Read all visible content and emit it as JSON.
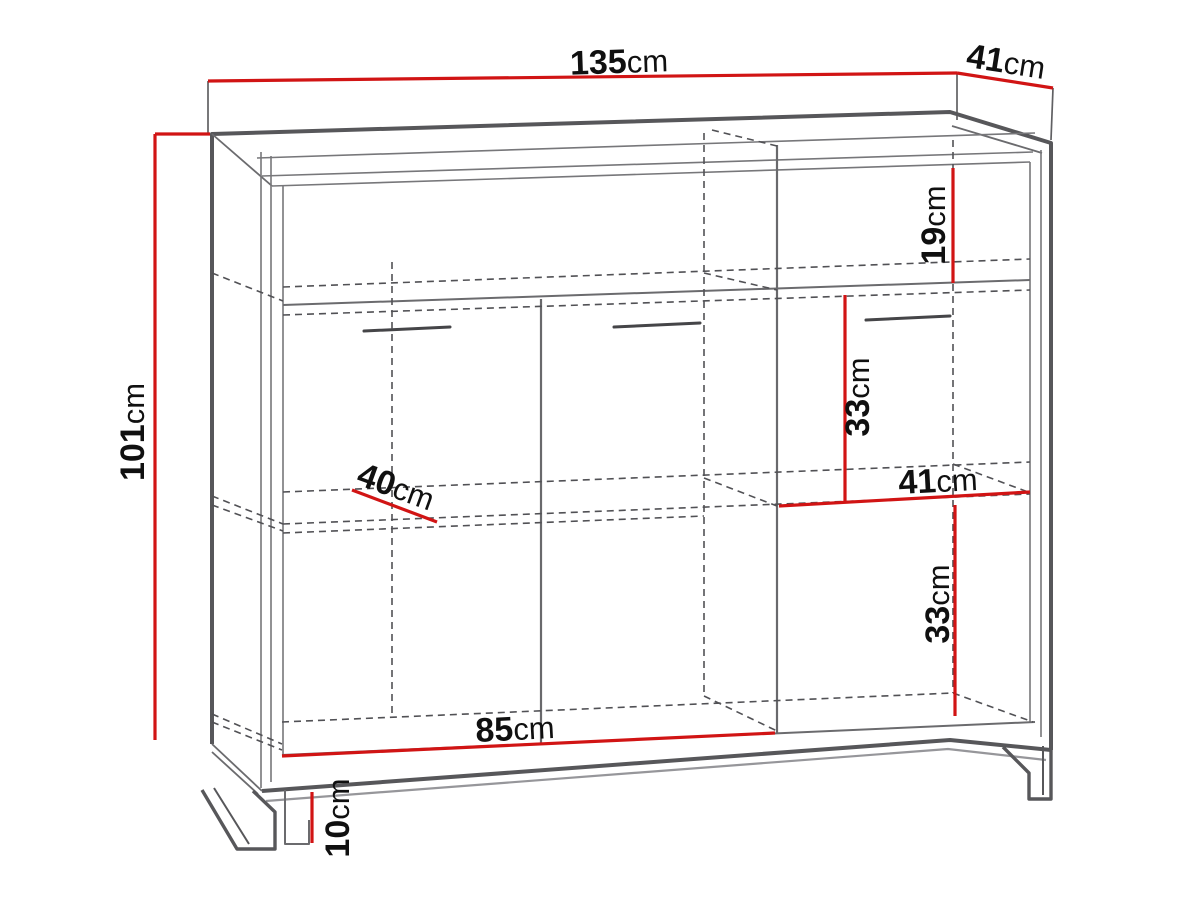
{
  "diagram": {
    "type": "furniture-dimension-drawing",
    "unit": "cm",
    "dimensions": {
      "width": {
        "value": "135",
        "unit": "cm"
      },
      "depth": {
        "value": "41",
        "unit": "cm"
      },
      "height": {
        "value": "101",
        "unit": "cm"
      },
      "top_shelf": {
        "value": "19",
        "unit": "cm"
      },
      "upper_section": {
        "value": "33",
        "unit": "cm"
      },
      "inner_depth": {
        "value": "41",
        "unit": "cm"
      },
      "lower_section": {
        "value": "33",
        "unit": "cm"
      },
      "inner_width": {
        "value": "85",
        "unit": "cm"
      },
      "leg_height": {
        "value": "10",
        "unit": "cm"
      },
      "shelf_depth": {
        "value": "40",
        "unit": "cm"
      }
    },
    "colors": {
      "dimension_line": "#d11414",
      "outline": "#57575a",
      "thin_line": "#77777a",
      "dashed_line": "#515155",
      "text": "#101010",
      "background": "#ffffff"
    }
  }
}
